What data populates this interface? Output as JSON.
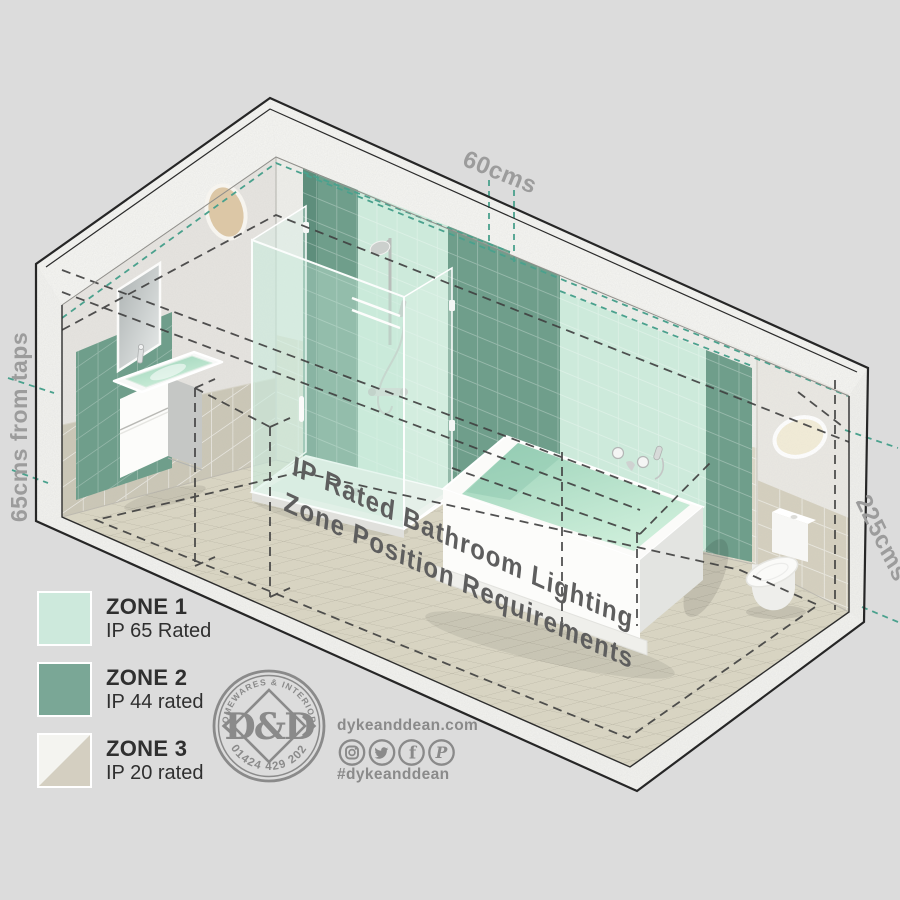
{
  "page": {
    "background": "#dcdcdc"
  },
  "scene": {
    "floor_title": {
      "line1": "IP Rated Bathroom Lighting",
      "line2": "Zone Position Requirements"
    },
    "dimension_labels": {
      "top": "60cms",
      "left": "65cms from taps",
      "right": "225cms"
    }
  },
  "legend": {
    "items": [
      {
        "zone": "ZONE 1",
        "rating": "IP 65 Rated",
        "color": "#cde9dc",
        "style": "solid"
      },
      {
        "zone": "ZONE 2",
        "rating": "IP 44 rated",
        "color": "#7aa796",
        "style": "solid"
      },
      {
        "zone": "ZONE 3",
        "rating": "IP 20 rated",
        "color": "#d4cfc1",
        "color_secondary": "#f4f4f0",
        "style": "diagonal-split"
      }
    ]
  },
  "brand": {
    "badge": {
      "arc_top": "HOMEWARES & INTERIORS",
      "arc_bottom": "01424 429 202",
      "monogram": "D&D"
    },
    "website": "dykeanddean.com",
    "hashtag": "#dykeanddean",
    "social_icons": [
      "instagram",
      "twitter",
      "facebook",
      "pinterest"
    ],
    "social_glyphs": {
      "facebook": "f",
      "pinterest": "P"
    }
  },
  "palette": {
    "zone1_mint": "#cdeadb",
    "zone2_green": "#6f9e8b",
    "zone3_beige": "#d4cfc1",
    "teal_dash": "#4aa18d",
    "dash_dark": "#3f3f3f",
    "label_gray": "#9c9c9c",
    "floor_text_gray": "#5e5e5e",
    "brand_gray": "#8a8a8a"
  }
}
